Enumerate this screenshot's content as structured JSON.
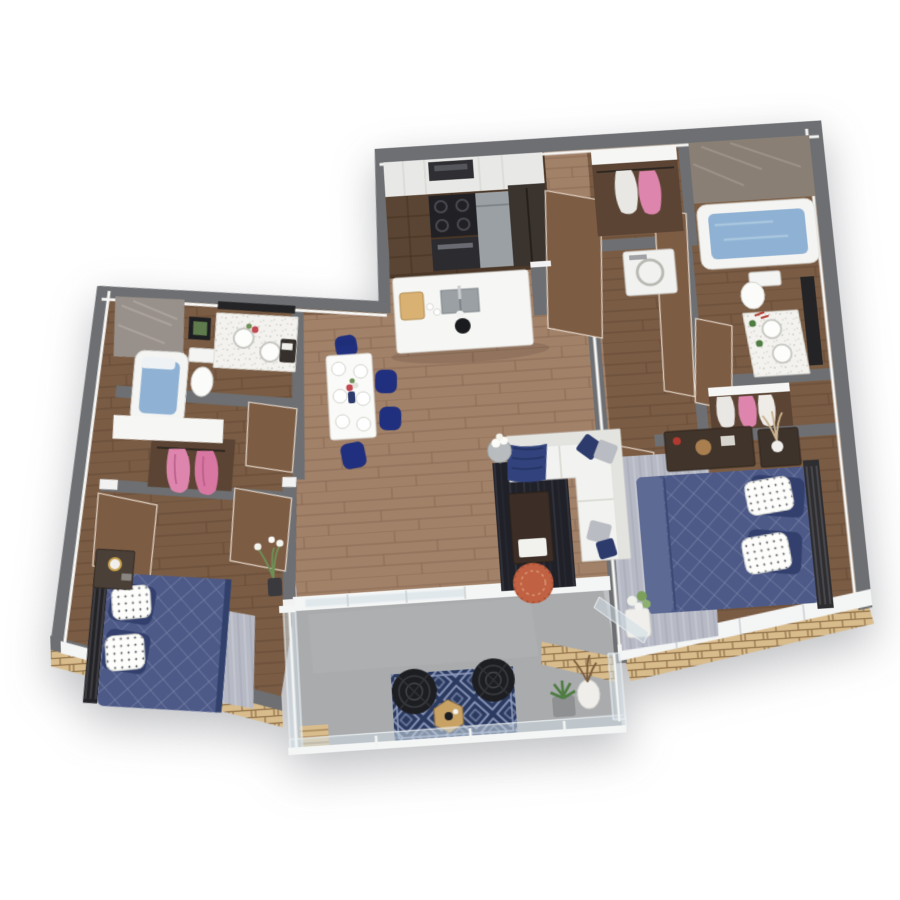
{
  "palette": {
    "wall": "#6d6f72",
    "wall-dk": "#5e6063",
    "wall-light": "#dfe0e2",
    "wood-light": "#a28169",
    "wood-light-seam": "#8a6a52",
    "wood-mid": "#7a5c44",
    "wood-mid-seam": "#654a35",
    "wood-dark": "#4c3828",
    "wood-dark-seam": "#3a2a1d",
    "concrete": "#a9abad",
    "brick": "#d9bc8c",
    "brick-mortar": "#8f7048",
    "bed-navy": "#4d5a88",
    "bed-navy-line": "#6c79a4",
    "chair-navy": "#20307e",
    "rug-balcony": "#2b3a60",
    "rug-balcony-line": "#96a2c4",
    "rug-dark": "#202128",
    "rug-gray": "#b7bac5",
    "pink": "#dd85ac",
    "copper": "#bf6142",
    "door-brown": "#7d5c44",
    "glass": "#ccd6dd",
    "tile-taupe": "#8a7f74",
    "marble-gray": "#98908a",
    "water-blue": "#8fb2d4",
    "stainless": "#9aa0a4",
    "black": "#1a1b1e"
  },
  "scene": {
    "type": "3d-floor-plan-render",
    "style": "top-down isometric apartment on white background",
    "rooms": [
      {
        "name": "Kitchen",
        "furniture": [
          "upper cabinets",
          "wall oven",
          "black cooktop range",
          "base cabinets",
          "dishwasher",
          "refrigerator",
          "white island with sink and faucet",
          "cutting board",
          "black vase",
          "cups"
        ]
      },
      {
        "name": "Entry Hall",
        "furniture": [
          "open wood doors"
        ]
      },
      {
        "name": "Laundry Closet",
        "furniture": [
          "hanging clothes",
          "white washer"
        ]
      },
      {
        "name": "Bathroom 2",
        "furniture": [
          "marble accent wall",
          "soaking tub with water",
          "toilet",
          "double vessel-sink vanity",
          "dark framed mirror",
          "small plants"
        ]
      },
      {
        "name": "Walk-in Closet",
        "furniture": [
          "white shelving",
          "hanging white and pink clothes"
        ]
      },
      {
        "name": "Bedroom 2",
        "furniture": [
          "navy quilted bed",
          "dark metal headboard",
          "white dotted and navy pillows",
          "gray area rug",
          "media console with decor",
          "nightstand with pampas vase",
          "potted flowers",
          "glass window wall"
        ]
      },
      {
        "name": "Living Room",
        "furniture": [
          "white sectional sofa",
          "navy and gray pillows",
          "navy throw",
          "charcoal rug",
          "dark walnut coffee table with white tray",
          "copper pouf",
          "round side table with white flowers"
        ]
      },
      {
        "name": "Dining Area",
        "furniture": [
          "white dining table",
          "six place settings",
          "flower centerpiece",
          "royal navy velvet chairs"
        ]
      },
      {
        "name": "Bathroom 1",
        "furniture": [
          "marble shower wall",
          "soaking tub with water",
          "toilet",
          "double vessel-sink vanity",
          "dark framed mirror",
          "framed botanical art"
        ]
      },
      {
        "name": "Dressing Hall",
        "furniture": [
          "white wardrobe shelf",
          "pink dresses on rod",
          "open wood doors"
        ]
      },
      {
        "name": "Bedroom 1",
        "furniture": [
          "navy quilted bed",
          "black ladder headboard",
          "white dotted pillows",
          "dark nightstand with brass lamp",
          "gray rug",
          "tall vase with white flowers"
        ]
      },
      {
        "name": "Balcony",
        "furniture": [
          "glass railing",
          "navy moroccan-pattern rug",
          "two black wire chairs",
          "hexagon wood side table",
          "succulent and dried-branch planters",
          "brick accent wall",
          "wood deck tiles"
        ]
      }
    ]
  }
}
